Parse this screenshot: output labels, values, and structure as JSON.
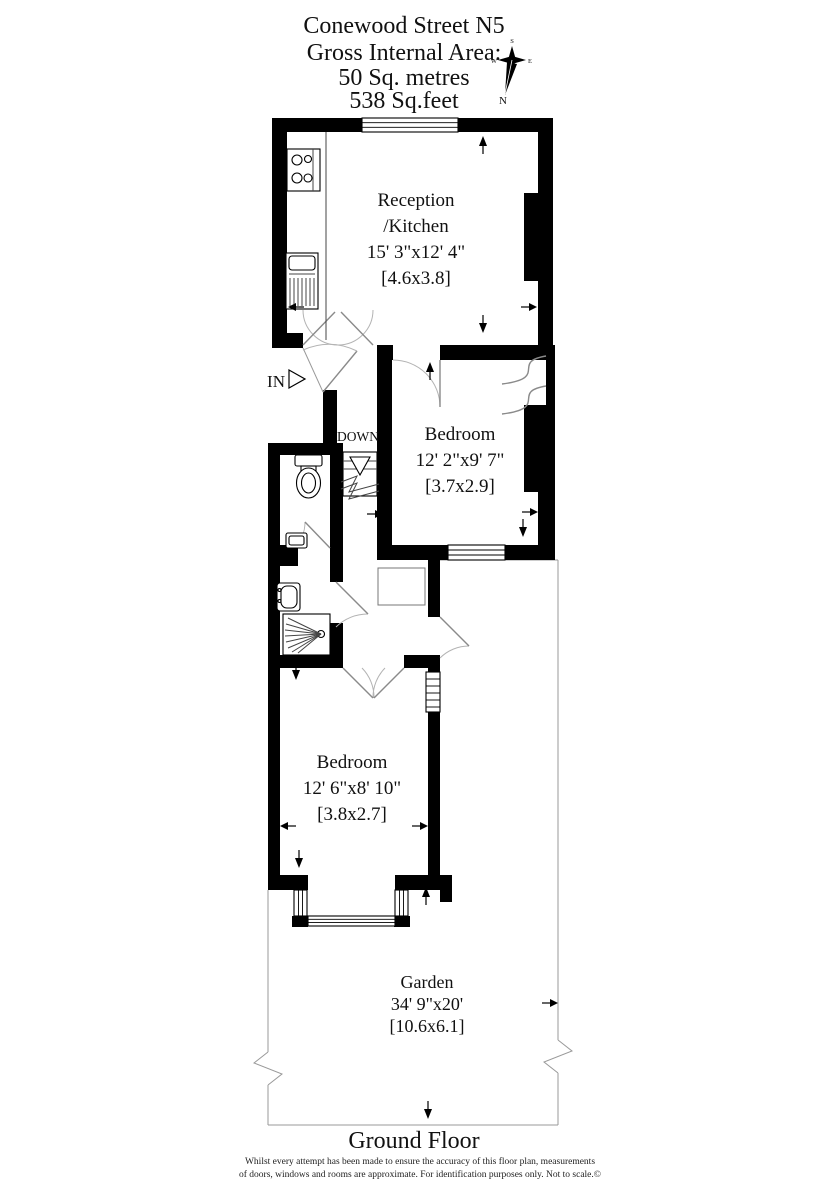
{
  "title": {
    "line1": "Conewood Street N5",
    "line2": "Gross Internal Area:",
    "line3": "50 Sq. metres",
    "line4": "538 Sq.feet"
  },
  "compass": {
    "north": "N",
    "south": "S",
    "east": "E",
    "west": "W"
  },
  "rooms": {
    "reception": {
      "name1": "Reception",
      "name2": "/Kitchen",
      "dims": "15' 3\"x12' 4\"",
      "metric": "[4.6x3.8]"
    },
    "bedroom1": {
      "name": "Bedroom",
      "dims": "12' 2\"x9' 7\"",
      "metric": "[3.7x2.9]"
    },
    "bedroom2": {
      "name": "Bedroom",
      "dims": "12' 6\"x8' 10\"",
      "metric": "[3.8x2.7]"
    },
    "garden": {
      "name": "Garden",
      "dims": "34' 9\"x20'",
      "metric": "[10.6x6.1]"
    }
  },
  "labels": {
    "entrance": "IN",
    "stairs": "DOWN"
  },
  "footer": {
    "floor": "Ground Floor",
    "disclaimer1": "Whilst every attempt has been made to ensure the accuracy of this floor plan, measurements",
    "disclaimer2": "of doors, windows and rooms are approximate. For identification purposes only. Not to scale.©"
  },
  "colors": {
    "wall": "#000000",
    "boundary_line": "#999999",
    "door_arc": "#b3b3b3",
    "text": "#111111",
    "background": "#ffffff"
  }
}
